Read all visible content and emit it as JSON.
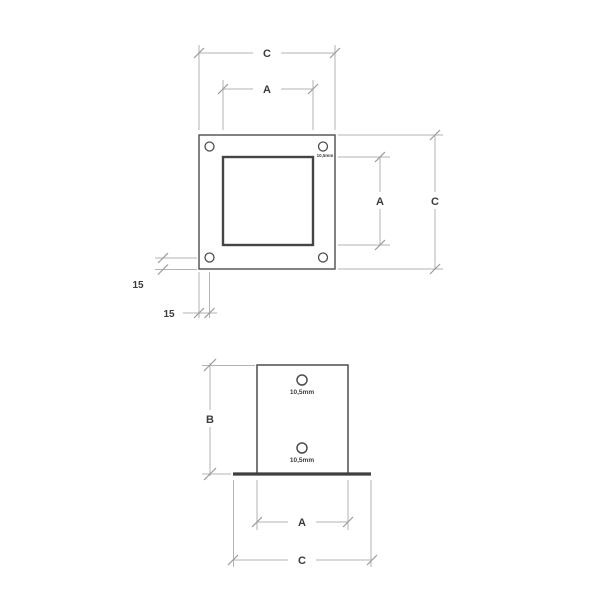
{
  "drawing": {
    "type": "technical-dimension-drawing",
    "views": [
      "top-view",
      "front-view"
    ],
    "colors": {
      "background": "#ffffff",
      "object_line": "#4d4d4d",
      "heavy_line": "#3f3f3f",
      "dimension_line": "#b3b3b3",
      "tick_mark": "#9a9a9a",
      "text": "#3b3b3b"
    },
    "top_view": {
      "labels": {
        "outer_width": "C",
        "inner_width": "A",
        "inner_height": "A",
        "outer_height": "C",
        "hole_offset_vertical": "15",
        "hole_offset_horizontal": "15",
        "hole_diameter": "10,5mm"
      },
      "features": {
        "corner_holes": 4,
        "outer_plate": "square",
        "inner_tube": "square"
      }
    },
    "front_view": {
      "labels": {
        "height": "B",
        "inner_width": "A",
        "outer_width": "C",
        "top_hole_diameter": "10,5mm",
        "bottom_hole_diameter": "10,5mm"
      },
      "features": {
        "holes": 2,
        "base_plate": "flat",
        "tube": "rectangular"
      }
    }
  }
}
